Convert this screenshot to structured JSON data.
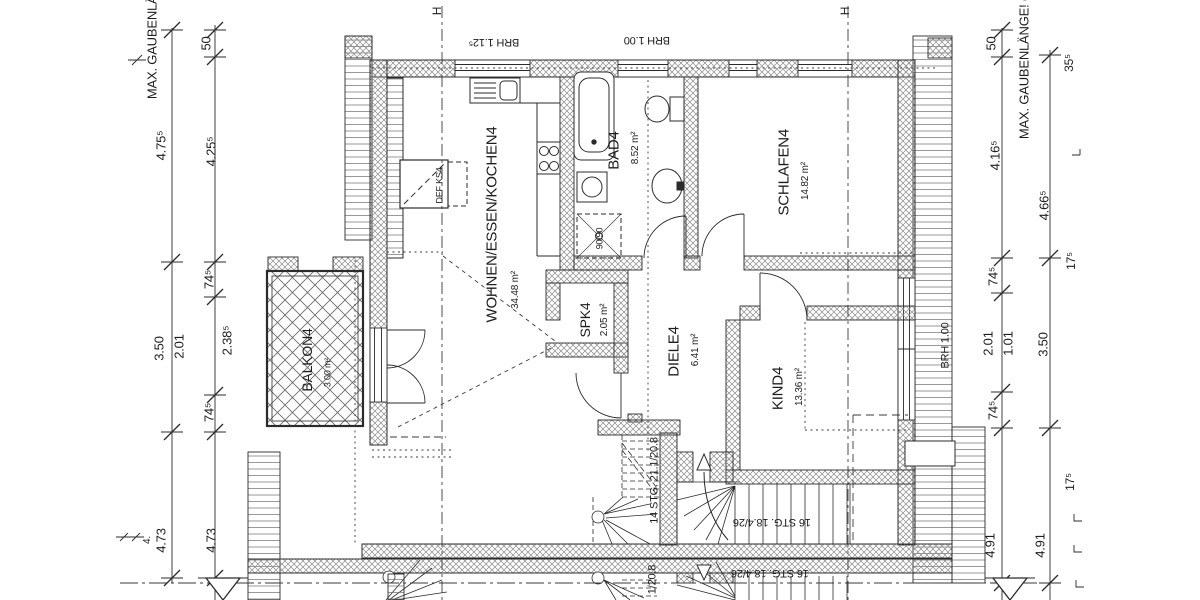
{
  "title": "Dachgeschoss Grundriss (floor plan)",
  "colors": {
    "line": "#2b2b2b",
    "background": "#ffffff",
    "hatch": "#777777"
  },
  "labels": {
    "left_roof": "MAX. GAUBENLÄNGE",
    "right_roof": "MAX. GAUBENLÄNGE! (1",
    "h_marker": "H",
    "brh_112": "BRH 1.12⁵",
    "brh_100_top": "BRH 1.00",
    "brh_100_right": "BRH 1.00",
    "def_ks": "DEF KS4",
    "shower": "90/90",
    "stair_14": "14 STG. 21.1/20.8",
    "stair_16": "16 STG. 18.4/26",
    "stair_16_mirror": "16 STG. 18.4/26",
    "stair_14_mirror_fragment": "1/20.8"
  },
  "rooms": {
    "living": {
      "name": "WOHNEN/ESSEN/KOCHEN4",
      "area": "34.48 m²"
    },
    "bath": {
      "name": "BAD4",
      "area": "8.52 m²"
    },
    "bedroom": {
      "name": "SCHLAFEN4",
      "area": "14.82 m²"
    },
    "pantry": {
      "name": "SPK4",
      "area": "2.05 m²"
    },
    "hall": {
      "name": "DIELE4",
      "area": "6.41 m²"
    },
    "child": {
      "name": "KIND4",
      "area": "13.36 m²"
    },
    "balcony": {
      "name": "BALKON4",
      "area": "3.00 m²"
    }
  },
  "dims": {
    "left_outer": {
      "top": "4.75⁵",
      "mid": "3.50",
      "bottom": "4.73"
    },
    "left_inner": {
      "d50": "50",
      "top": "4.25⁵",
      "k745a": "74⁵",
      "d201": "2.01",
      "d2385": "2.38⁵",
      "k745b": "74⁵",
      "bottom": "4.73",
      "fragment": "4."
    },
    "right_inner": {
      "d50": "50",
      "top": "4.16⁵",
      "k745a": "74⁵",
      "d201": "2.01",
      "d101": "1.01",
      "k745b": "74⁵",
      "bottom": "4.91"
    },
    "right_outer": {
      "top": "4.66⁵",
      "mid": "3.50",
      "bottom": "4.91"
    },
    "right_edge": {
      "d355": "35⁵",
      "d175a": "17⁵",
      "d175b": "17⁵"
    }
  }
}
